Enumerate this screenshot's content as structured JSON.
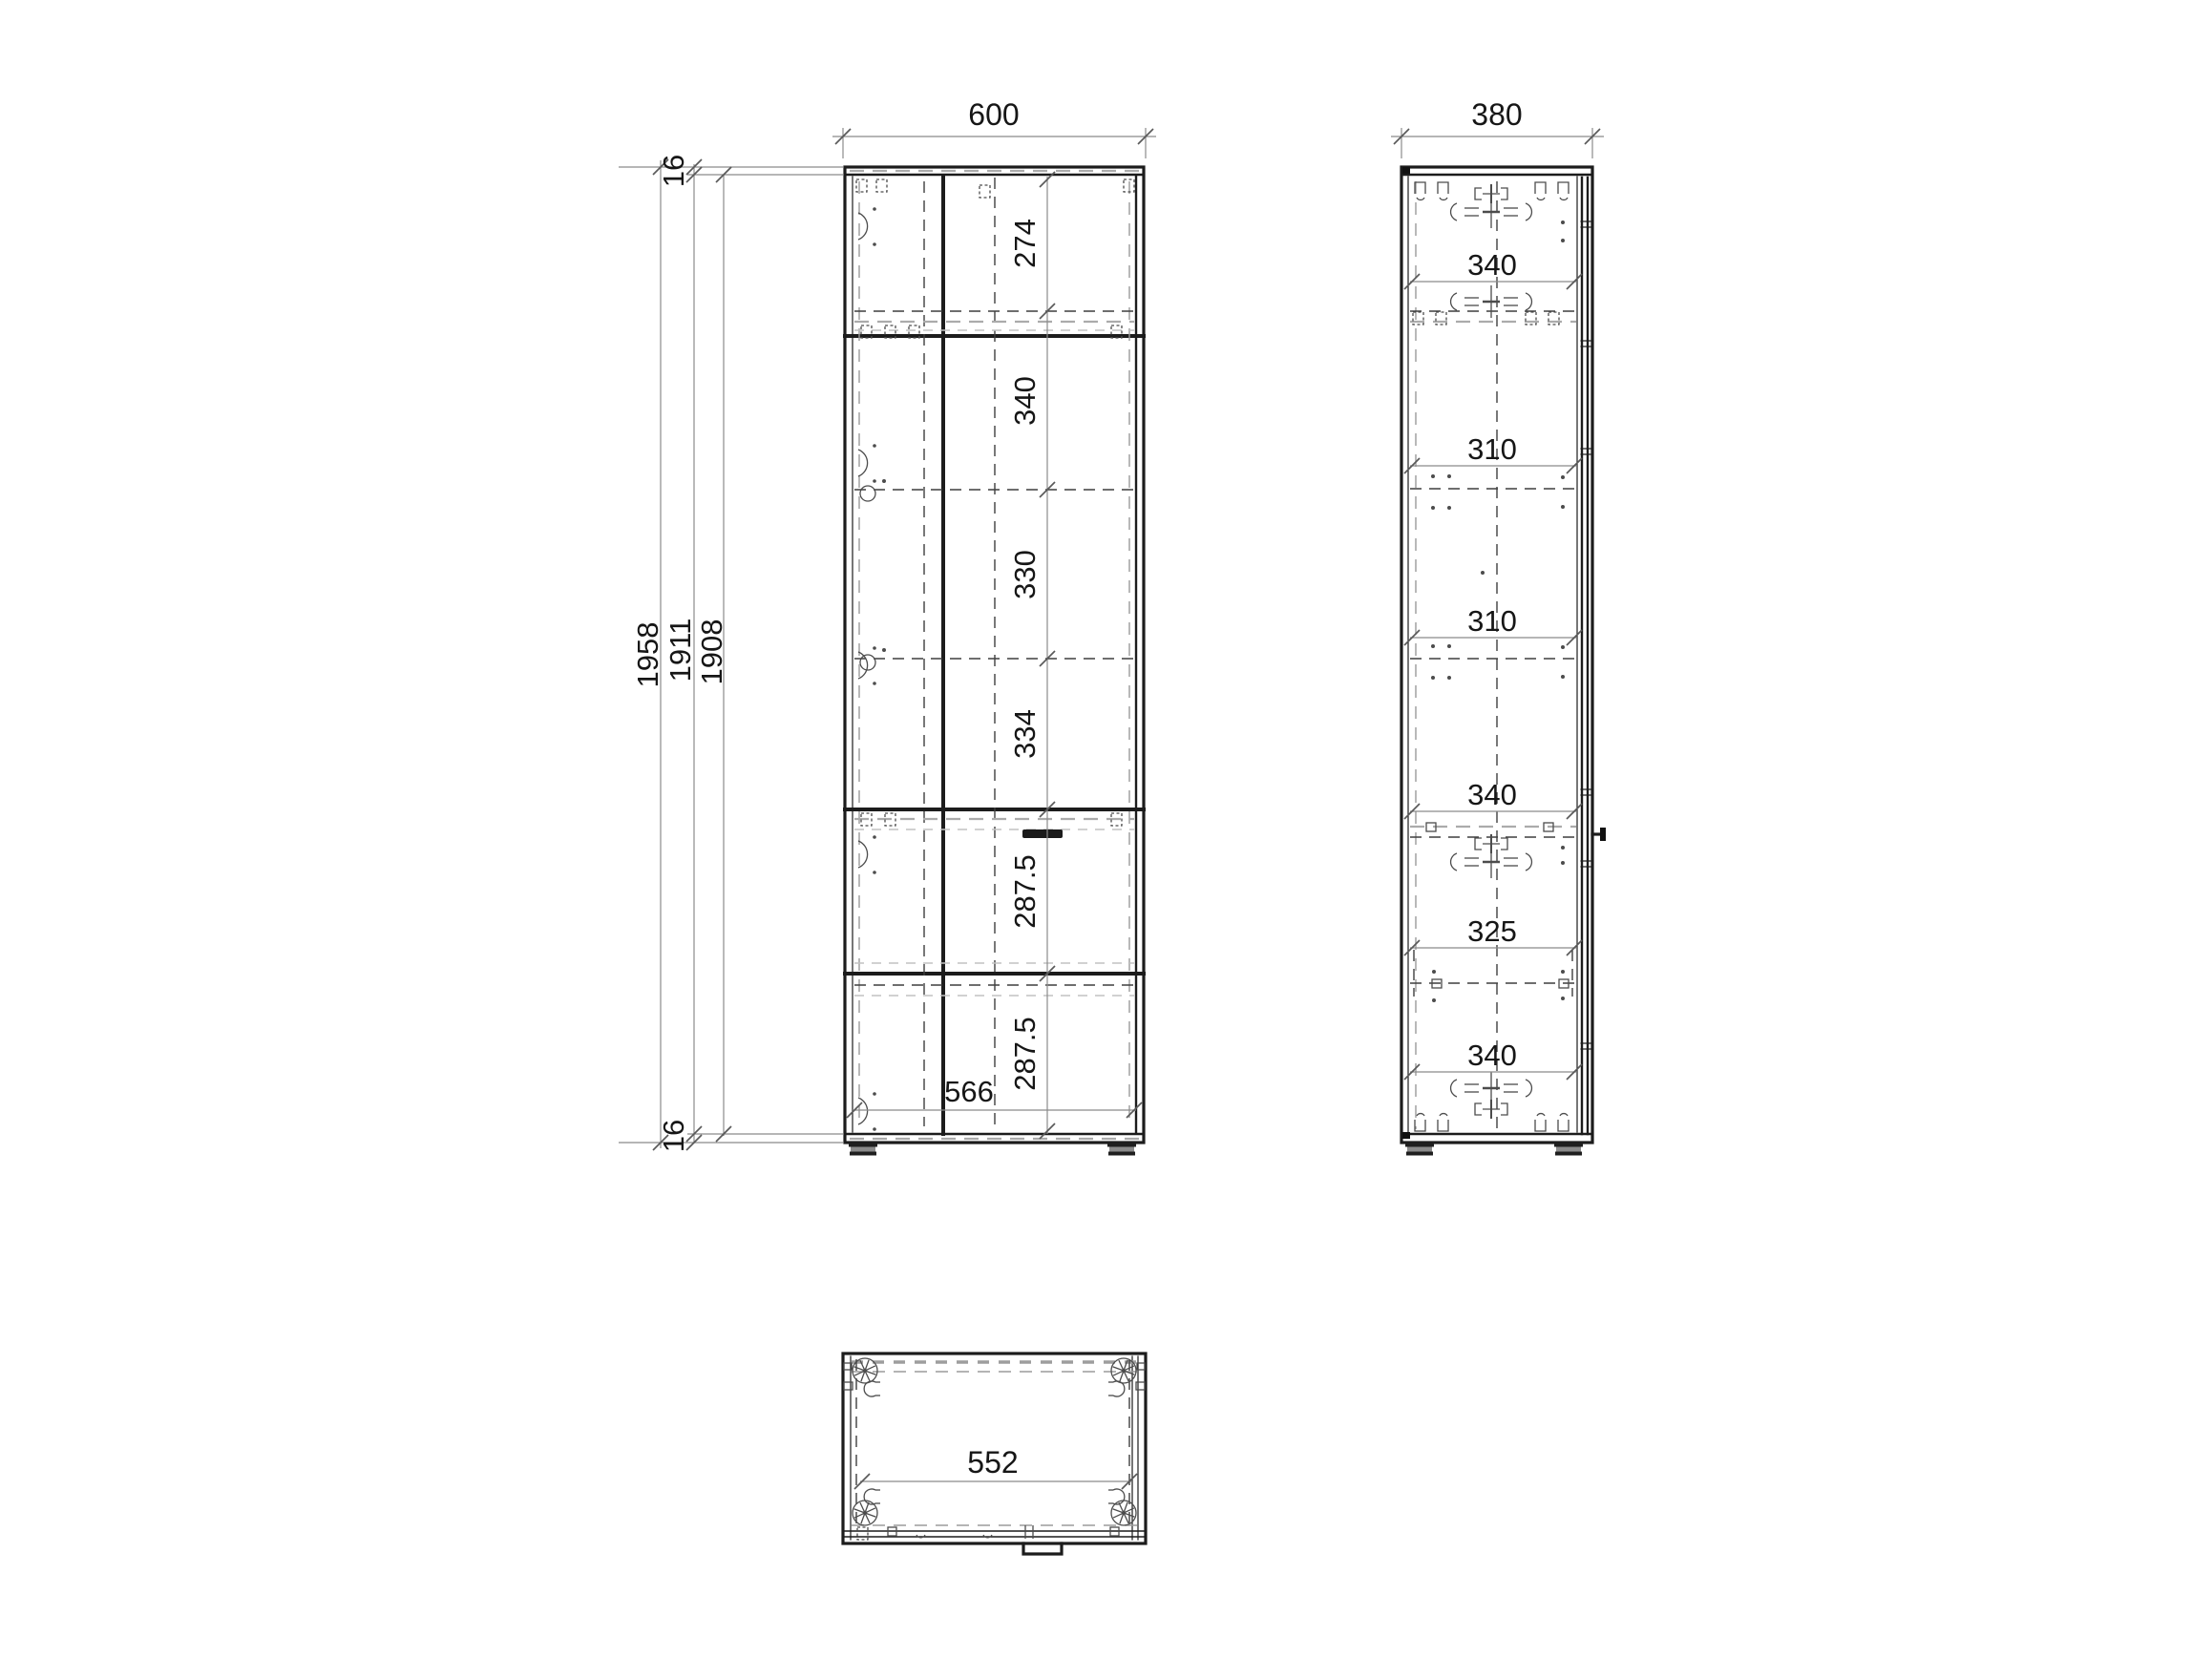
{
  "front_view": {
    "width": "600",
    "top_panel_thickness": "16",
    "bottom_panel_thickness": "16",
    "heights": [
      "1958",
      "1911",
      "1908"
    ],
    "sections": [
      "274",
      "340",
      "330",
      "334",
      "287.5",
      "287.5"
    ],
    "interior_width": "566"
  },
  "side_view": {
    "depth": "380",
    "sections": [
      "340",
      "310",
      "310",
      "340",
      "325",
      "340"
    ]
  },
  "plan_view": {
    "interior_width": "552"
  },
  "colors": {
    "line": "#1c1c1c",
    "hidden_line": "#9b9b9b",
    "dimension_line": "#8b8b8b",
    "background": "#ffffff"
  }
}
